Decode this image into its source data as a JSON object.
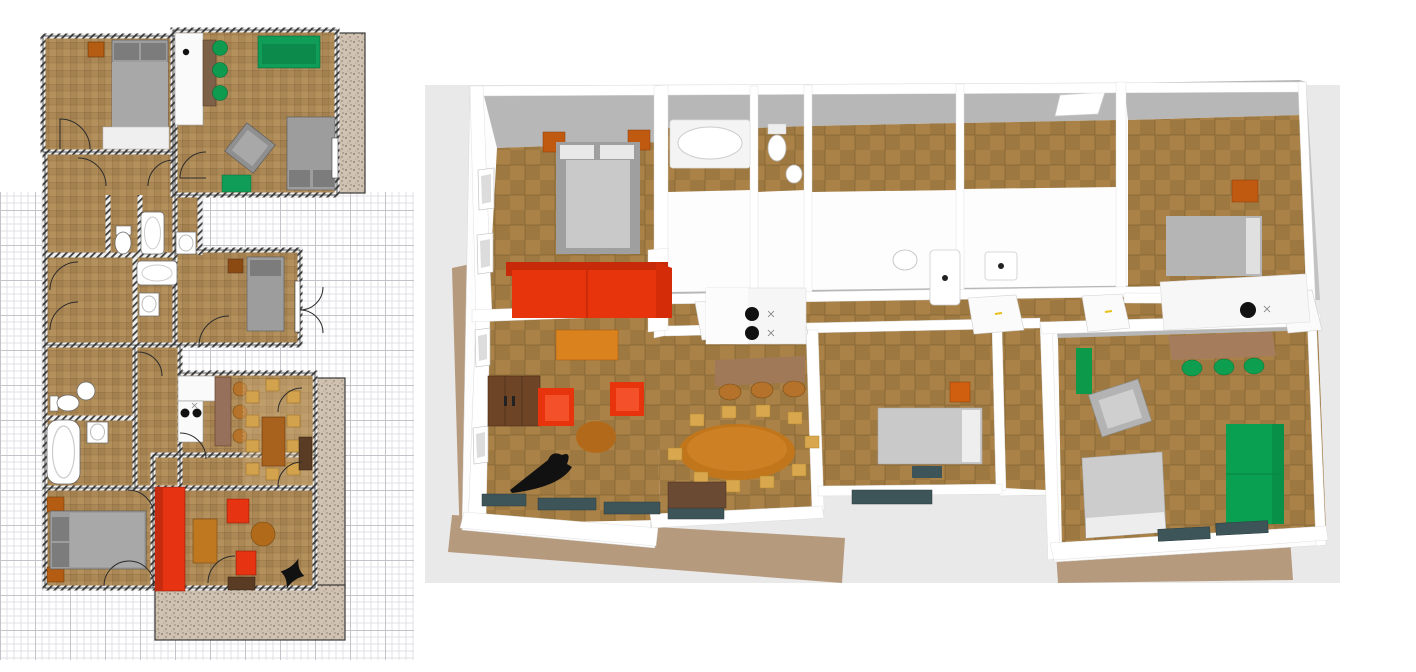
{
  "workspace": {
    "kind": "floor-plan-designer",
    "background": "#ffffff",
    "panels": [
      {
        "id": "plan-2d",
        "kind": "2d-floor-plan",
        "grid_paper": true,
        "position": "left"
      },
      {
        "id": "view-3d",
        "kind": "3d-aerial-render",
        "background": "#e9e9e9",
        "position": "right"
      }
    ]
  },
  "palette": {
    "plan_floor": "#b4915c",
    "plan_wall": "#3d3d3d",
    "terrace_speckle": "#cfc2b2",
    "grid_minor": "#e0e0e4",
    "grid_major": "#c3c3c9",
    "floor_3d": "#aa8248",
    "wall_face_3d": "#b7b7b7",
    "wall_top_3d": "#ffffff",
    "sofa_red": "#e8340c",
    "sofa_green": "#0aa052",
    "bed_gray": "#9d9d9d",
    "nightstand_orange": "#c05a10",
    "table_brown": "#c2761c",
    "chair_tan": "#d9a84e",
    "bar_brown": "#96705a",
    "cabinet_brown": "#6e4426",
    "sideboard_dark": "#5a3c24",
    "radiator_teal": "#3d5458",
    "door_handle_yellow": "#e8c01c",
    "fixture_white": "#ffffff"
  },
  "plan_2d": {
    "rooms": [
      {
        "name": "bedroom-top-left",
        "furniture": [
          "double-bed",
          "nightstand",
          "rug",
          "door"
        ]
      },
      {
        "name": "studio-top-right",
        "furniture": [
          "kitchenette",
          "bar-counter",
          "bar-stools-green",
          "green-sofa",
          "double-bed",
          "swivel-armchair",
          "green-side-table",
          "window"
        ],
        "bar_stools": 3
      },
      {
        "name": "wc-1",
        "furniture": [
          "toilet"
        ]
      },
      {
        "name": "bathroom-1",
        "furniture": [
          "bathtub",
          "sink"
        ]
      },
      {
        "name": "bathroom-2",
        "furniture": [
          "bathtub",
          "sink"
        ]
      },
      {
        "name": "bedroom-middle",
        "furniture": [
          "single-bed",
          "nightstand",
          "window",
          "exterior-french-doors"
        ]
      },
      {
        "name": "wc-2",
        "furniture": [
          "toilet",
          "sink"
        ]
      },
      {
        "name": "bathroom-3",
        "furniture": [
          "bathtub",
          "sink"
        ]
      },
      {
        "name": "corridor",
        "furniture": [
          "doors"
        ]
      },
      {
        "name": "kitchen-dining",
        "furniture": [
          "l-counter",
          "cooktop-2-burners",
          "bar-island",
          "bar-stools-brown",
          "dining-table",
          "dining-chairs",
          "sideboard",
          "area-rug",
          "french-doors"
        ],
        "bar_stools": 3,
        "dining_chairs": 10
      },
      {
        "name": "bedroom-bottom-left",
        "furniture": [
          "double-bed",
          "nightstand-pair",
          "double-entry-door"
        ]
      },
      {
        "name": "living-room",
        "furniture": [
          "red-sofa",
          "ochre-coffee-table",
          "red-armchair-pair",
          "round-table",
          "tv-stand",
          "black-plant",
          "french-doors"
        ]
      },
      {
        "name": "terraces",
        "count": 3
      }
    ]
  },
  "view_3d": {
    "camera": "aerial-oblique",
    "rooms": [
      {
        "name": "bedroom-top-left",
        "furniture": [
          "double-bed",
          "orange-nightstand-pair",
          "windows"
        ]
      },
      {
        "name": "bathroom-top",
        "furniture": [
          "bathtub"
        ]
      },
      {
        "name": "wc-top",
        "furniture": [
          "toilet",
          "corner-sink"
        ]
      },
      {
        "name": "hall-rooms-top",
        "furniture": [
          "white-doors-yellow-handles",
          "skylight"
        ]
      },
      {
        "name": "bedroom-right",
        "furniture": [
          "double-bed",
          "orange-nightstand"
        ]
      },
      {
        "name": "bathrooms-middle",
        "furniture": [
          "sink",
          "vertical-tub",
          "sink-cabinet"
        ]
      },
      {
        "name": "living-room",
        "furniture": [
          "red-sofa",
          "orange-coffee-table",
          "wall-cabinet",
          "red-armchair-pair",
          "round-table",
          "black-decor",
          "radiators",
          "windows"
        ]
      },
      {
        "name": "kitchen-dining",
        "furniture": [
          "white-counter",
          "cooktop-2-burners",
          "bar-with-stools",
          "oval-dining-table",
          "tan-chairs",
          "sideboard",
          "radiator"
        ],
        "tan_chairs": 10,
        "bar_stools": 3
      },
      {
        "name": "bedroom-small-middle",
        "furniture": [
          "single-bed",
          "orange-nightstand",
          "radiator"
        ]
      },
      {
        "name": "studio-bottom-right",
        "furniture": [
          "kitchenette-counter",
          "green-bookcase",
          "desk",
          "green-stools",
          "gray-armchair",
          "green-sofa",
          "bed",
          "radiators"
        ],
        "green_stools": 3
      }
    ],
    "terraces": [
      "left-strip",
      "bottom-band",
      "bottom-right-band"
    ]
  }
}
